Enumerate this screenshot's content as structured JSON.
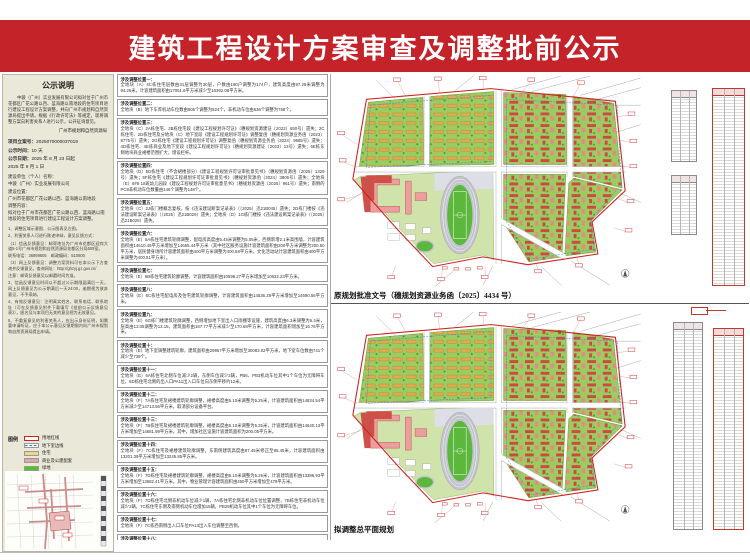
{
  "banner": {
    "title": "建筑工程设计方案审查及调整批前公示"
  },
  "sidebar": {
    "header": "公示说明",
    "intro": "中骏（广州）实业发展有限公司拟对位于广州市花都区广花公路以西、蓝海路以南地段的住宅项目进行建设工程设计方案调整，并向广州市规划和自然资源局提出申请。根据《行政许可法》等规定，现将调整方案向利害关系人进行公示，公开征询意见。",
    "agency": "广州市规划和自然资源局",
    "fields": [
      {
        "label": "项目立案号：",
        "value": "2025070000037019"
      },
      {
        "label": "公示时间：",
        "value": "10 天"
      },
      {
        "label": "公示日期：",
        "value": "2025 年 8 月 23 日起"
      },
      {
        "label": "",
        "value": "2025 年 9 月 1 日"
      }
    ],
    "unit_block": [
      "建设单位（个人）名称：",
      "中骏（广州）实业发展有限公司",
      "建设位置：",
      "广州市花都区广花公路以西、蓝海路以南地段",
      "调整内容：",
      "拟对位于广州市花都区广花公路以西、蓝海路以南地段的住宅项目进行建设工程设计方案调整。"
    ],
    "notes": [
      "1、调整区域示意图、公示图表见左图。",
      "2、利害关系人可进行陈述申辩，意见反馈方式：",
      "（1）信函反馈意见：邮寄地址为广州市花都区迎宾大道5-1号广州市规划和自然资源局花都区分局509室。",
      "联系电话：36999605　邮政编码：510800",
      "（2）网上反馈意见：调整方案资料可在本公示下方查询并反馈意见，查询网址：http://ghzyj.gz.gov.cn/",
      "注意：邮寄反馈意见以邮戳时间为准。",
      "3、信函反馈意见时间以不超过公示期限届满后一天，网上反馈意见为公示期满后一天24:00，逾期视为放弃意见，不予采纳。",
      "4、有效反馈意见：注明真实姓名、联系电话、联系地址（可在反馈意见附件下载填写《批前公示反馈意见表》），匿名及与本项目无关的意见视为无效意见。",
      "5、不重复意见的利害关系人，应出示身份证明，如需要申请听证，应于本公示意见反馈期限内向广州市规划和自然资源局提出申请。"
    ],
    "legend": {
      "title": "图例",
      "items": [
        {
          "label": "用地红线",
          "type": "red-line"
        },
        {
          "label": "地下室边线",
          "type": "blue-dash"
        },
        {
          "label": "住宅",
          "type": "yellow"
        },
        {
          "label": "商业及公建配套",
          "type": "pink"
        },
        {
          "label": "绿地",
          "type": "green"
        }
      ]
    }
  },
  "adjustments": [
    {
      "label": "涉及调整位置一：",
      "text": "全地块（A）4C栋住宅层数由31层调整为30层，户数由180户调整为174户，建筑高度由97.25米调整为94.25米，计容建筑面积由17051.6平方米减少至16392.08平方米。"
    },
    {
      "label": "涉及调整位置二：",
      "text": "全地块（B）地下车库机动车位数由805个调整为824个，非机动车位由636个调整为768个。"
    },
    {
      "label": "涉及调整位置三：",
      "text": "全地块（C）2A栋住宅、2B栋住宅段《建设工程规划许可证》（穗规划资源建证〔2022〕650号）遗失；2C栋住宅、2D栋住宅及分地块（C）地下室段《建设工程规划许可证》调整复函（穗规划资源业务函〔2023〕8775号）遗失；2G栋住宅《建设工程规划许可证》调整复函（穗规划资源业务函〔2024〕9685号）遗失；4D栋住宅、4E栋商业及地下室段《建设工程规划许可证》（穗规划资源建证〔2023〕13号）遗失；6E栋东侧地块商业裙楼范围扩大，增设栏杆。"
    },
    {
      "label": "涉及调整位置四：",
      "text": "全地块（D）5D栋住宅（不含裙楼部分）《建设工程规划许可证审批意见书》（穗规划资源函〔2025〕1329号）遗失；5F栋住宅《建设工程规划许可证审批意见书》（穗规划资源函〔2024〕3806号）遗失；全地块（E）6F8 18班幼儿园段《建设工程规划许可证审批意见书》（穗规划资源函〔2025〕961号）遗失；南侧的PC8非机动车位数量由146个调整为148个。"
    },
    {
      "label": "涉及调整位置五：",
      "text": "全地块（C）2J栋门楼概念复核，按《违法建设断案记录表》（〔2025〕迅21B045）遗失；2D栋门楼按《违法建设断案记录表》（〔2025〕迅21B029）遗失；全地块（D）1G栋门楼按《违法建设断案记录表》（〔2025〕迅21B028）遗失。"
    },
    {
      "label": "涉及调整位置六：",
      "text": "全地块（E）6A栋住宅建筑轮廓调整，配电房高度由5.45米调整为5.05米，西侧新增2.1米高围墙，计容建筑面积由14610.45平方米增加至14655.44平方米（其中社区服务设施计容建筑面积由200平方米调整为200.50平方米，居民健身场所计容建筑面积由400平方米调整为400.58平方米，文化活动站计容建筑面积由400平方米调整为400.51平方米）。"
    },
    {
      "label": "涉及调整位置七：",
      "text": "全地块（E）6B栋住宅建筑轮廓调整，计容建筑面积由10598.27平方米增加至10622.23平方米。"
    },
    {
      "label": "涉及调整位置八：",
      "text": "全地块（E）6C栋住宅配电房及住宅建筑轮廓调整，计容建筑面积由14536.28平方米增加至14590.56平方米。"
    },
    {
      "label": "涉及调整位置九：",
      "text": "全地块（E）6G栋门楼建筑轮廓调整，西侧增加地下室出入口雨棚等设施，建筑高度由6.3米调整为6.4米，层高由13.05调整为13.15，建筑面积由187.77平方米减少至170.68平方米，计容建筑面积增加至16.76平方米。"
    },
    {
      "label": "涉及调整位置十：",
      "text": "全地块（E）地下室调整建筑轮廓，建筑面积由29967平方米增加至30083.02平方米，地下室车位数由741个减少至739个。"
    },
    {
      "label": "涉及调整位置十一：",
      "text": "全地块（E）6A栋住宅北侧车位减少2辆，东侧车位减少2辆，PB6、PB3机动车位其中1个车位为无障碍车位，6D栋住宅北侧的出入口PA11出入口车位向东侧平移约12米。"
    },
    {
      "label": "涉及调整位置十二：",
      "text": "全地块（F）7A栋住宅及裙楼建筑轮廓调整，裙楼高度由5.10米调整为5.25米，计容建筑面积由14834.54平方米减少至14713.56平方米，取消部分设备平台。"
    },
    {
      "label": "涉及调整位置十三：",
      "text": "全地块（F）7B栋住宅及裙楼建筑轮廓调整，裙楼高度由5.10米调整为5.25米，计容建筑面积由14640.13平方米增加至14681.99平方米。其中，增加社区设施计容建筑面积为200.05平方米。"
    },
    {
      "label": "涉及调整位置十四：",
      "text": "全地块（F）7C栋住宅及裙楼建筑轮廓调整，东南侧建筑高度由87.45米修正至85.45米，计容建筑面积由13201.39平方米增加至13245.85平方米。"
    },
    {
      "label": "涉及调整位置十五：",
      "text": "全地块（F）7D栋住宅及裙楼建筑轮廓调整，裙楼高度由5.10米调整为5.25米，计容建筑面积由13386.93平方米增加至13682.41平方米。其中，物业管理计容建筑面积由450平方米增加至478平方米。"
    },
    {
      "label": "涉及调整位置十六：",
      "text": "全地块（F）7D栋住宅北侧非机动车位减少1辆，7A栋住宅北侧非机动车位位置调整，7B栋住宅非机动车位减少2辆，7C栋住宅东侧及南侧机动车位增加15辆，PB29机动车位其中1个车位为无障碍车位。"
    },
    {
      "label": "涉及调整位置十七：",
      "text": "全地块（F）7C栋西南侧出入口车位PA13出入车位调整至西侧。"
    },
    {
      "label": "涉及调整位置十八：",
      "text": "全地块（A）、（C）、（F）室外标高场地做法调整，在全地块（E）6A栋、6C栋，全地块（F）7A栋、7B栋、7C栋、7D栋屋顶层增加617.95平方米建设绿地。"
    },
    {
      "label": "涉及调整位置十九：",
      "text": "涉及绿地、暖通、道路、车位布局调整，调整了下沉景观水池，分地块（C）中心公园配电系统装饰做法。户数由4019户调整为4013户，总建筑面积由640638.93平方米调整为640500.64平方米，建蔽率由25.8%调整为26.85%，绿地率由36.78%调整为35.22%，非机动车位由6288个调整为6227个。"
    }
  ],
  "maps": {
    "top_caption": "原规划批准文号（穗规划资源业务函〔2025〕4434 号）",
    "bottom_caption": "拟调整总平面规划"
  },
  "colors": {
    "banner_red": "#c4232a",
    "sidebar_beige": "#eae8d8",
    "boundary_red": "#cc2222",
    "parcel_green": "#9ccb62",
    "building_red": "#cd4a43",
    "building_yellow": "#e2aa4e",
    "school_pink": "#ec9e9e"
  }
}
